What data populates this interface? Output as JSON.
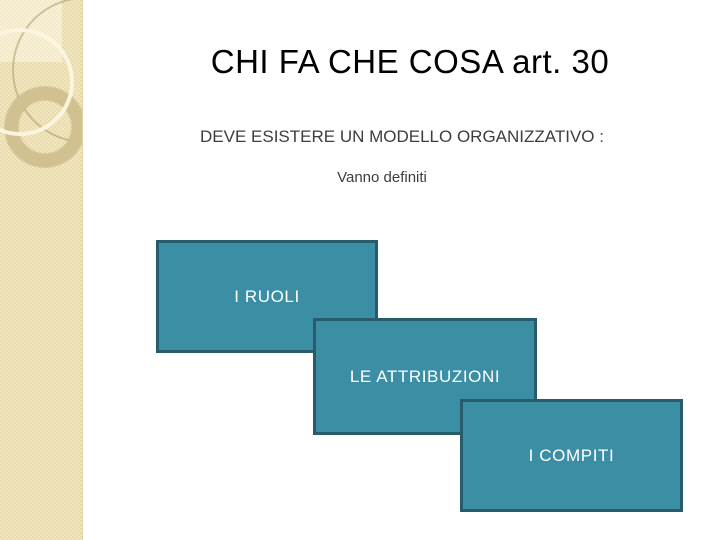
{
  "slide": {
    "title": "CHI FA CHE COSA art. 30",
    "statement": "DEVE ESISTERE UN MODELLO ORGANIZZATIVO :",
    "subheading": "Vanno definiti",
    "boxes": [
      {
        "label": "I RUOLI"
      },
      {
        "label": "LE ATTRIBUZIONI"
      },
      {
        "label": "I COMPITI"
      }
    ],
    "colors": {
      "background": "#FFFFFF",
      "band": "#E9DBAA",
      "band_checker_light": "#F1E6C3",
      "ring": "#D2C190",
      "title_text": "#000000",
      "body_text": "#3D3D3D",
      "box_fill": "#3C8EA4",
      "box_border": "#275D6B",
      "box_text": "#FFFFFF"
    }
  }
}
